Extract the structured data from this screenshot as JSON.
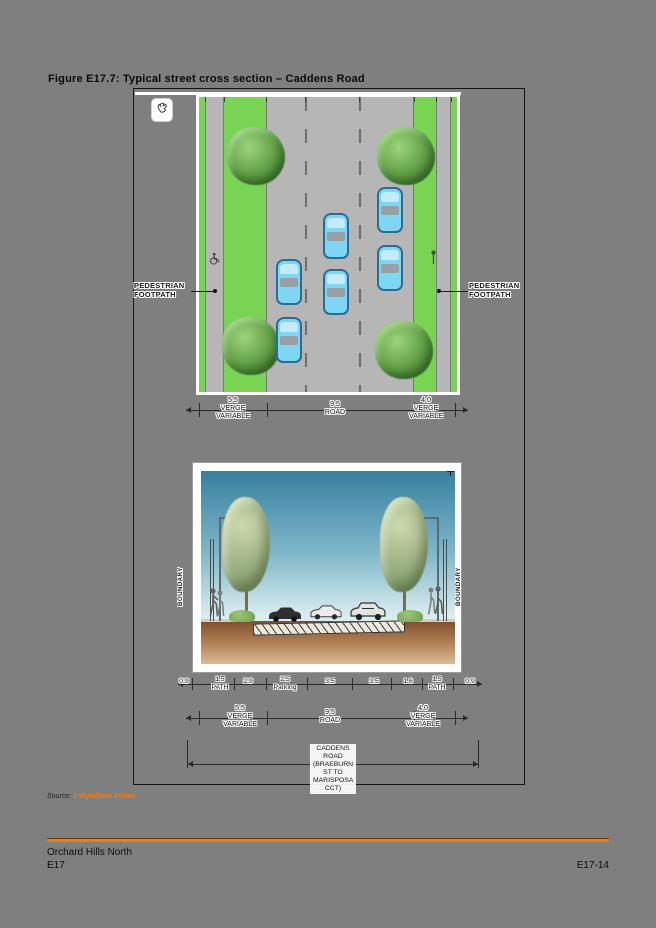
{
  "page": {
    "title": "Figure E17.7: Typical street cross section – Caddens Road"
  },
  "figure": {
    "plan": {
      "footpath_label_line1": "PEDESTRIAN",
      "footpath_label_line2": "FOOTPATH"
    },
    "plan_dims": [
      {
        "num": "5.5",
        "line1": "VERGE",
        "line2": "VARIABLE"
      },
      {
        "num": "9.5",
        "line1": "ROAD",
        "line2": ""
      },
      {
        "num": "4.0",
        "line1": "VERGE",
        "line2": "VARIABLE"
      }
    ],
    "section": {
      "boundary_label": "BOUNDARY"
    },
    "section_dims": [
      {
        "num": "0.9",
        "label": ""
      },
      {
        "num": "1.5",
        "label": "PATH"
      },
      {
        "num": "2.9",
        "label": ""
      },
      {
        "num": "2.5",
        "label": "Parking"
      },
      {
        "num": "3.5",
        "label": ""
      },
      {
        "num": "3.5",
        "label": ""
      },
      {
        "num": "1.6",
        "label": ""
      },
      {
        "num": "1.5",
        "label": "PATH"
      },
      {
        "num": "0.9",
        "label": ""
      }
    ],
    "verge_dims": [
      {
        "num": "5.5",
        "line1": "VERGE",
        "line2": "VARIABLE"
      },
      {
        "num": "9.5",
        "line1": "ROAD",
        "line2": ""
      },
      {
        "num": "4.0",
        "line1": "VERGE",
        "line2": "VARIABLE"
      }
    ],
    "road_extent": {
      "line1": "CADDENS ROAD",
      "line2": "(BRAEBURN ST TO",
      "line3": "MARISPOSA CCT)"
    }
  },
  "source": {
    "prefix": "Source:",
    "name": "J Wyndham Prince"
  },
  "footer": {
    "project": "Orchard Hills North",
    "chapter": "E17",
    "page_num": "E17-14"
  },
  "colors": {
    "accent_orange": "#ef7b1a",
    "verge_green": "#79d454",
    "car_blue": "#7fd6f2",
    "page_gray": "#7f7f7f",
    "sky_blue": "#38809f",
    "earth_brown": "#7d4f2e"
  }
}
